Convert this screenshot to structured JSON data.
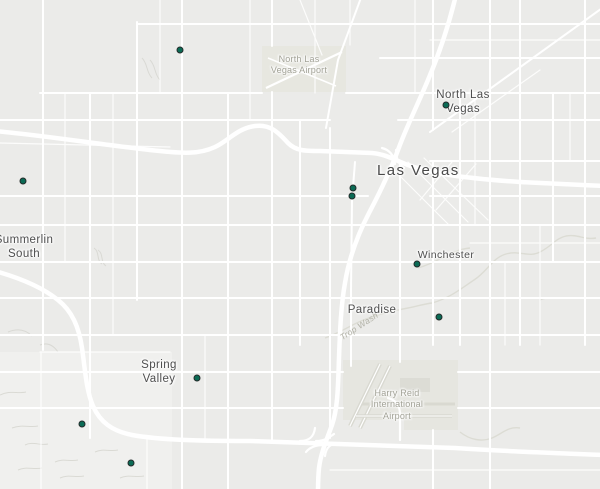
{
  "map": {
    "background_color": "#ebebe9",
    "road_color": "#ffffff",
    "airport_fill": "#e7e7e0",
    "terrain_color": "#d8d8d2",
    "marker_style": {
      "fill": "#0b6b55",
      "stroke": "#232b2a"
    },
    "labels": {
      "major_city": "Las Vegas",
      "places": [
        {
          "name": "North Las Vegas",
          "lines": [
            "North Las",
            "Vegas"
          ]
        },
        {
          "name": "Summerlin South",
          "lines": [
            "Summerlin",
            "South"
          ]
        },
        {
          "name": "Winchester",
          "lines": [
            "Winchester"
          ]
        },
        {
          "name": "Paradise",
          "lines": [
            "Paradise"
          ]
        },
        {
          "name": "Spring Valley",
          "lines": [
            "Spring",
            "Valley"
          ]
        }
      ],
      "airports": [
        {
          "name": "North Las Vegas Airport",
          "lines": [
            "North Las",
            "Vegas Airport"
          ]
        },
        {
          "name": "Harry Reid International Airport",
          "lines": [
            "Harry Reid",
            "International",
            "Airport"
          ]
        }
      ],
      "waterways": [
        {
          "name": "Trop Wash",
          "lines": [
            "Trop Wash"
          ]
        }
      ]
    },
    "markers": [
      {
        "x": 180,
        "y": 50
      },
      {
        "x": 446,
        "y": 105
      },
      {
        "x": 23,
        "y": 181
      },
      {
        "x": 353,
        "y": 188
      },
      {
        "x": 352,
        "y": 196
      },
      {
        "x": 417,
        "y": 264
      },
      {
        "x": 439,
        "y": 317
      },
      {
        "x": 197,
        "y": 378
      },
      {
        "x": 82,
        "y": 424
      },
      {
        "x": 131,
        "y": 463
      }
    ]
  }
}
